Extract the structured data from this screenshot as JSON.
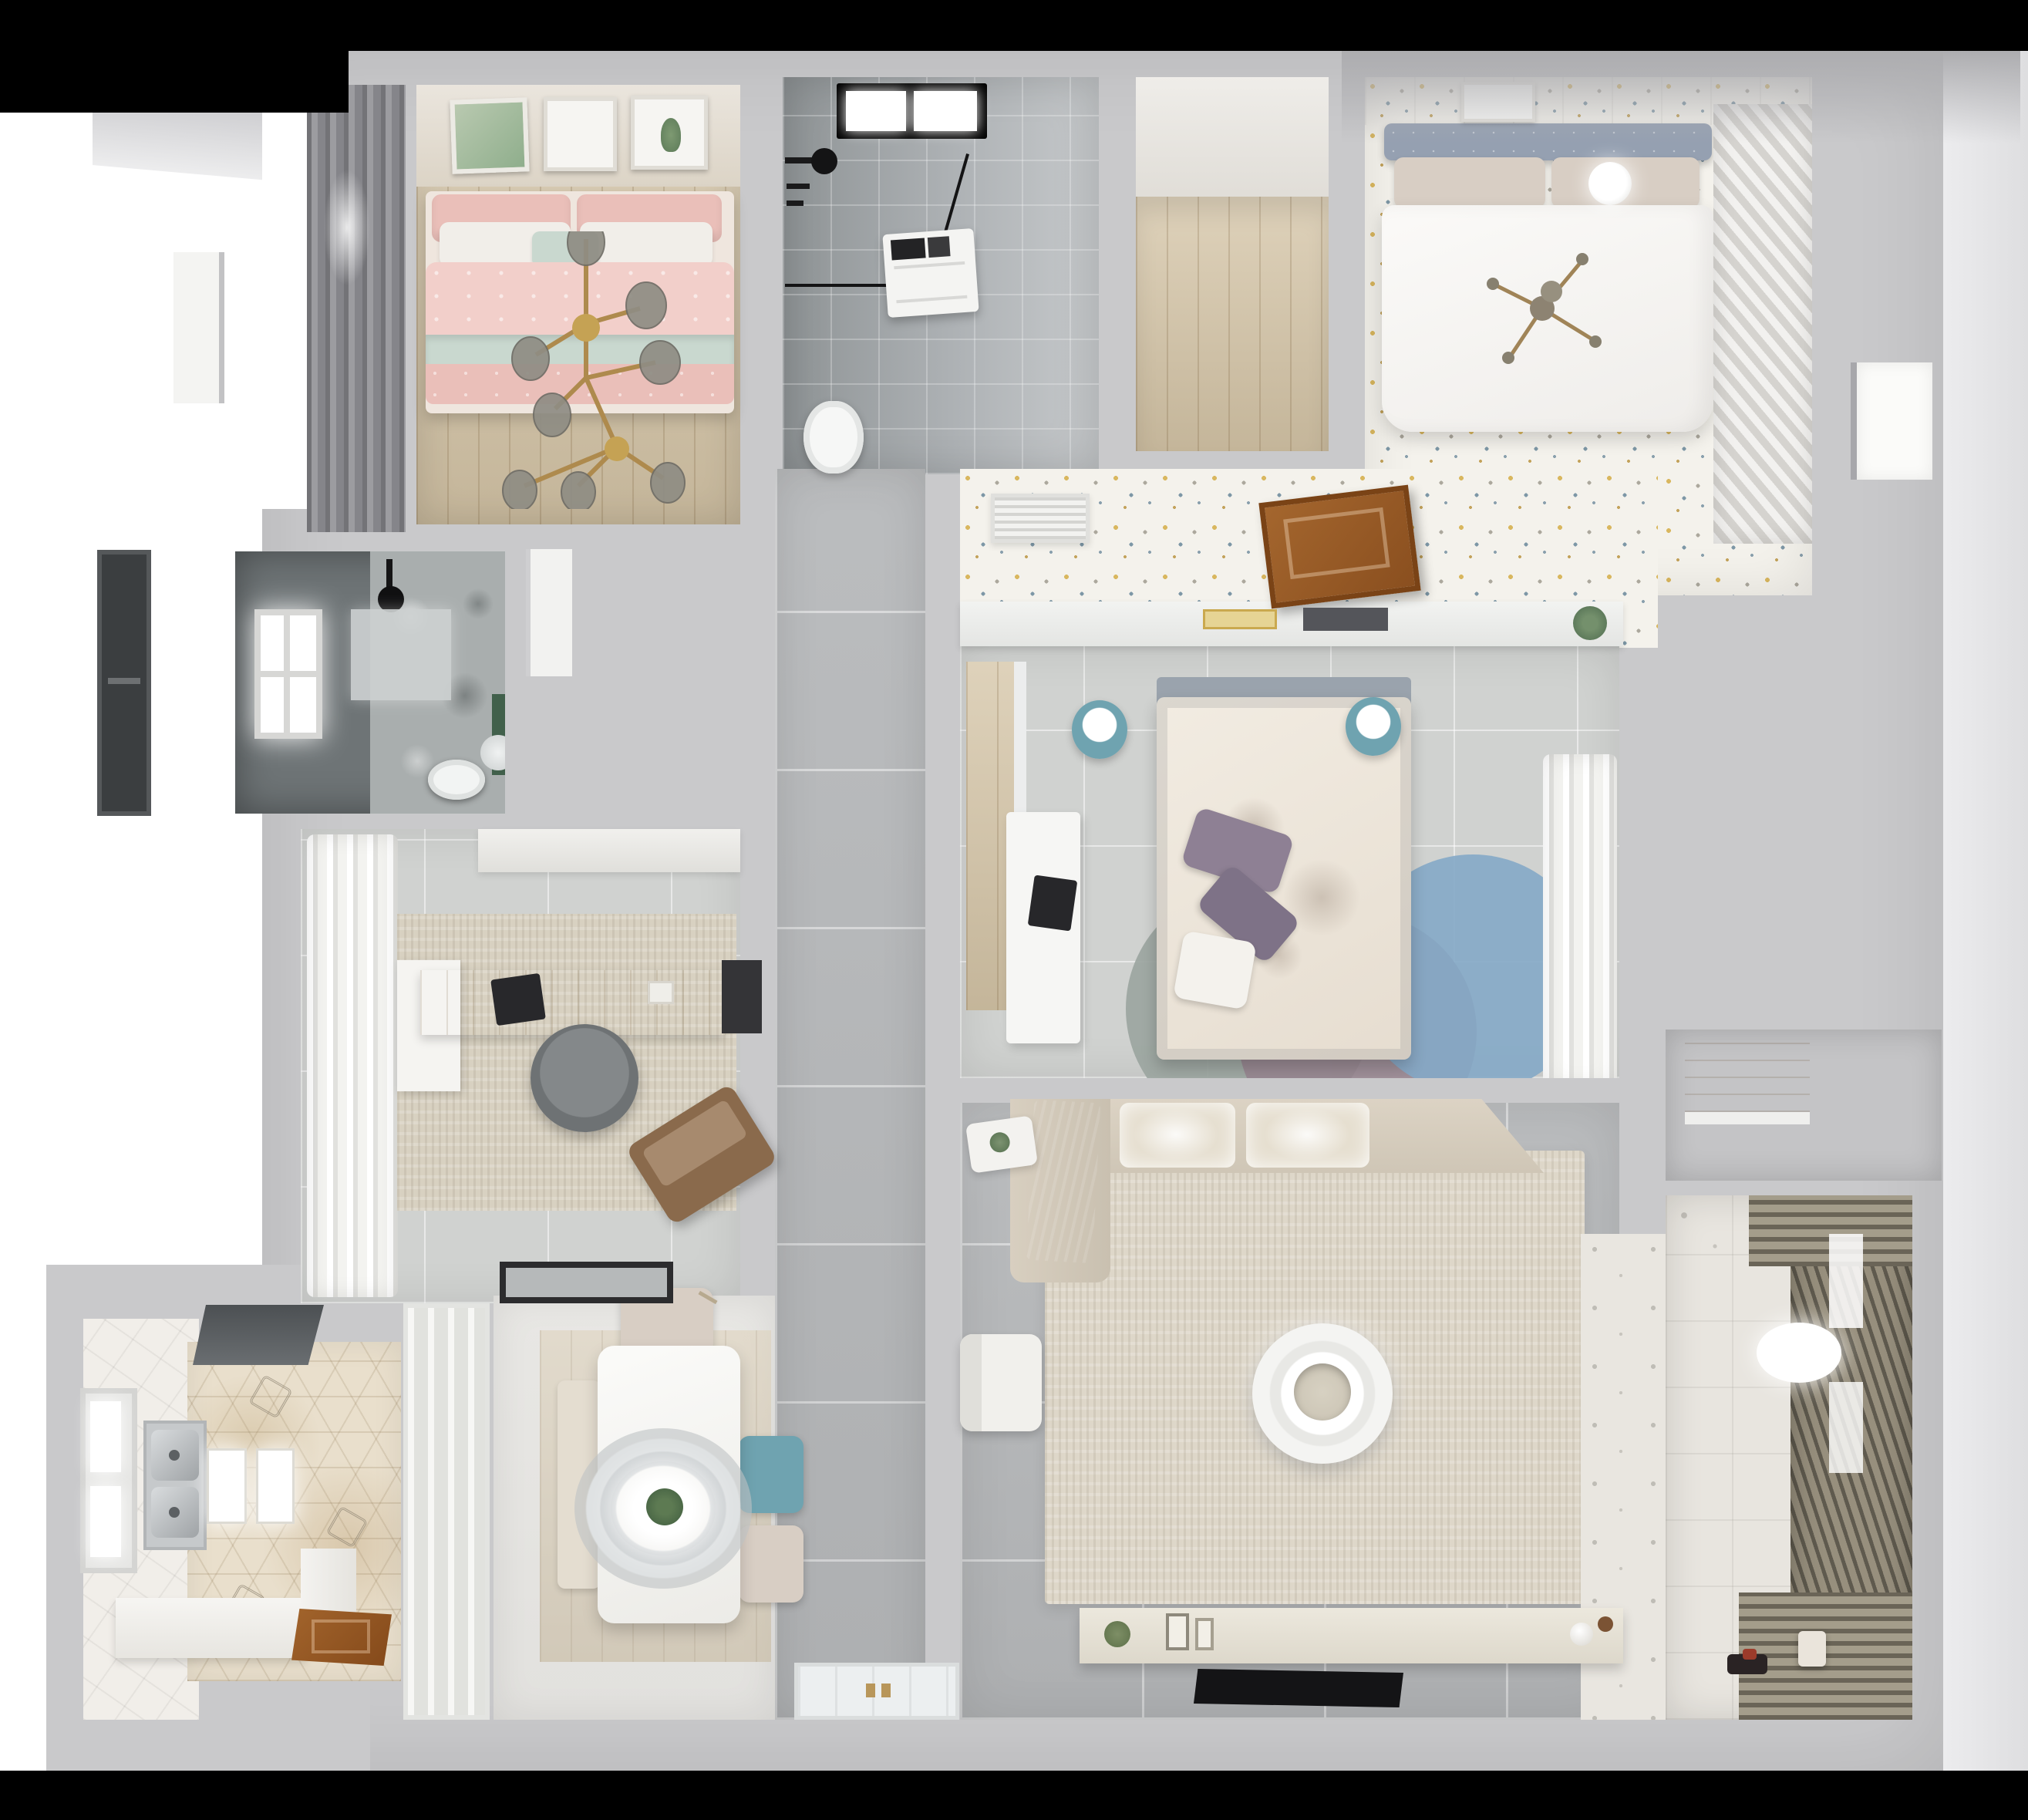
{
  "scene": {
    "type": "3d-rendered top-down apartment floor plan, no visible text",
    "rooms": [
      {
        "name": "bedroom-pink",
        "features": [
          "wood floor",
          "pink bed with mint throw",
          "gold branch chandelier",
          "three wall artworks",
          "gray window blind"
        ]
      },
      {
        "name": "bathroom-skylight",
        "features": [
          "gray tile",
          "black-framed skylight",
          "black shower fixture",
          "glass partition",
          "washing machine",
          "toilet"
        ]
      },
      {
        "name": "wood-nook",
        "features": [
          "light oak plank floor"
        ]
      },
      {
        "name": "bedroom-white",
        "features": [
          "speckled floor",
          "blue-gray tufted headboard",
          "white duvet",
          "round pendant lamp",
          "louvered wardrobe"
        ]
      },
      {
        "name": "speckled-hallway",
        "features": [
          "white vent grille",
          "open brown wood door",
          "shelf with books and plant"
        ]
      },
      {
        "name": "bedroom-center",
        "features": [
          "gray tile",
          "floral duvet bed",
          "purple pillows",
          "two teal stools",
          "white desk with laptop",
          "blue and mauve round rugs",
          "sheer curtains"
        ]
      },
      {
        "name": "bathroom-dark",
        "features": [
          "dark tiles",
          "glowing window",
          "black shower head",
          "marble floor",
          "toilet",
          "round mirror",
          "green accent"
        ]
      },
      {
        "name": "study",
        "features": [
          "billowing white curtains",
          "wood desk",
          "dark laptop",
          "gray office chair",
          "brown lounge chair",
          "beige rug",
          "door mat"
        ]
      },
      {
        "name": "corridor",
        "features": [
          "large gray floor tiles",
          "white entry door with brass handles"
        ]
      },
      {
        "name": "kitchen",
        "features": [
          "hexagon tile floor",
          "double stainless sink",
          "glowing counters",
          "range hood",
          "window",
          "open wood door",
          "frosted sliding door"
        ]
      },
      {
        "name": "dining",
        "features": [
          "white table",
          "oval ring pendant with plant",
          "teal chair",
          "two beige chairs",
          "wood bench"
        ]
      },
      {
        "name": "living-room",
        "features": [
          "beige sectional sofa with gray throw",
          "large cream rug",
          "round white coffee table",
          "white armchair",
          "side table with plant",
          "TV console with decor",
          "black TV"
        ]
      },
      {
        "name": "closet-nook",
        "features": [
          "wood back panel",
          "white shelf"
        ]
      },
      {
        "name": "balcony",
        "features": [
          "patterned tile floor",
          "louvered drying rack",
          "white pendant lamp",
          "toys",
          "small stool"
        ]
      }
    ],
    "background": {
      "top_bar": "black",
      "bottom_bar": "black",
      "surround": "white with soft gray wall gradients"
    }
  },
  "palette": {
    "ink": "#000000",
    "paper": "#ffffff",
    "wall": "#c9c9cb",
    "corridor": "#b7b9bb",
    "grout": "#d9dadb",
    "tileSoft": "#d0d2d0",
    "wood": "#d5c5a7",
    "pink": "#f2cfca",
    "pinkDeep": "#eabfb9",
    "mint": "#c9d8cf",
    "linen": "#f1eee9",
    "headboard": "#95a0b1",
    "beige": "#d8cec4",
    "speckle": "#f4f2ec",
    "bathGray": "#aeb2b5",
    "bathDeep": "#8f9496",
    "darkRoom": "#6e7476",
    "marble": "#a9aeae",
    "hexBase": "#e9dfcc",
    "rug": "#ded7c9",
    "rugWarm": "#d8d1c1",
    "cushion": "#e6dfd0",
    "teal": "#6fa3b0",
    "purple": "#8e8094",
    "blueRug": "#84a9c7",
    "mauveRug": "#97848f",
    "sageRug": "#9aa49e",
    "balconyTile": "#e8e5df",
    "louverA": "#5f5a4e",
    "louverB": "#978f7d",
    "gold": "#b8965a",
    "plant": "#41604b",
    "tv": "#141416"
  }
}
